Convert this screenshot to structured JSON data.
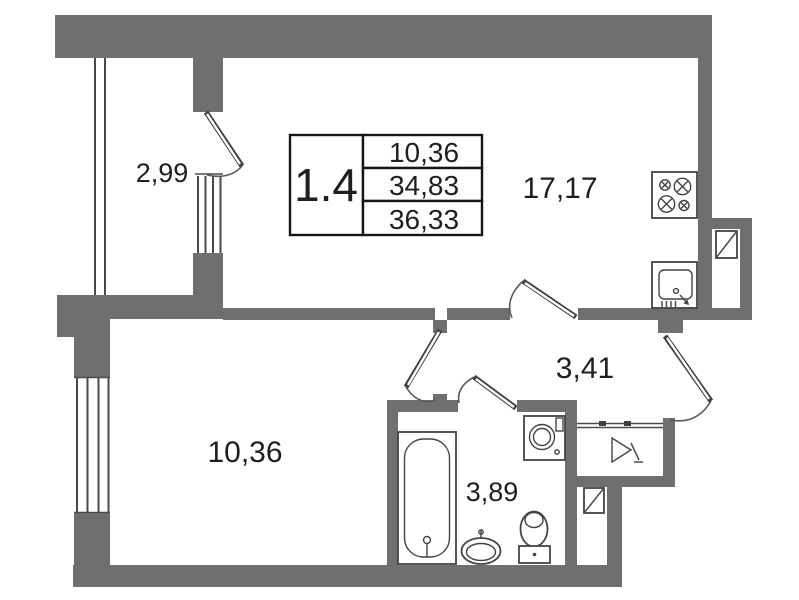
{
  "plan": {
    "background_color": "#ffffff",
    "wall_color": "#6f6f6f",
    "line_color": "#4a4a4a",
    "title_block": {
      "unit_number": "1.4",
      "values": [
        "10,36",
        "34,83",
        "36,33"
      ]
    },
    "rooms": [
      {
        "id": "balcony",
        "area": "2,99"
      },
      {
        "id": "living-kitchen",
        "area": "17,17"
      },
      {
        "id": "hallway",
        "area": "3,41"
      },
      {
        "id": "room",
        "area": "10,36"
      },
      {
        "id": "bathroom",
        "area": "3,89"
      }
    ],
    "icons": [
      "stove-icon",
      "kitchen-sink-icon",
      "ventilation-shaft-icon",
      "bathtub-icon",
      "washing-machine-icon",
      "washbasin-icon",
      "toilet-icon",
      "entry-marker-icon"
    ]
  }
}
